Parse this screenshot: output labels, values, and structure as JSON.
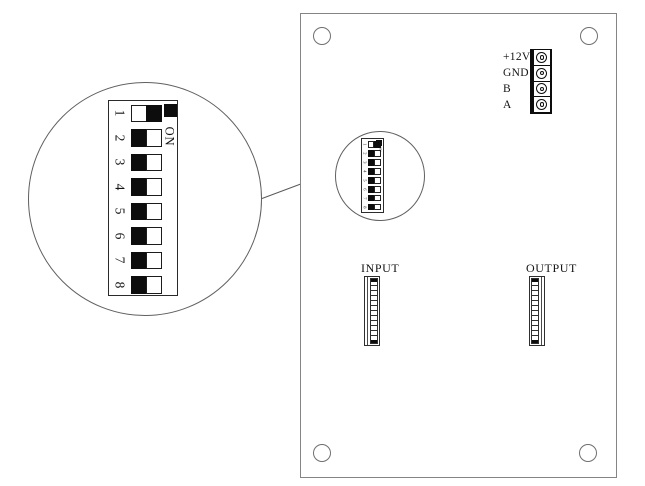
{
  "board": {
    "terminal_block": {
      "labels": [
        "+12V",
        "GND",
        "B",
        "A"
      ]
    },
    "connectors": {
      "input_label": "INPUT",
      "output_label": "OUTPUT",
      "pin_cells": 12
    }
  },
  "dip_switch": {
    "on_label": "ON",
    "switches": [
      {
        "number": "1",
        "state": "on"
      },
      {
        "number": "2",
        "state": "off"
      },
      {
        "number": "3",
        "state": "off"
      },
      {
        "number": "4",
        "state": "off"
      },
      {
        "number": "5",
        "state": "off"
      },
      {
        "number": "6",
        "state": "off"
      },
      {
        "number": "7",
        "state": "off"
      },
      {
        "number": "8",
        "state": "off"
      }
    ]
  },
  "colors": {
    "outline_gray": "#858585",
    "detail_line": "#606060",
    "ink": "#141414",
    "fill_black": "#0d0d0d",
    "background": "#ffffff"
  }
}
